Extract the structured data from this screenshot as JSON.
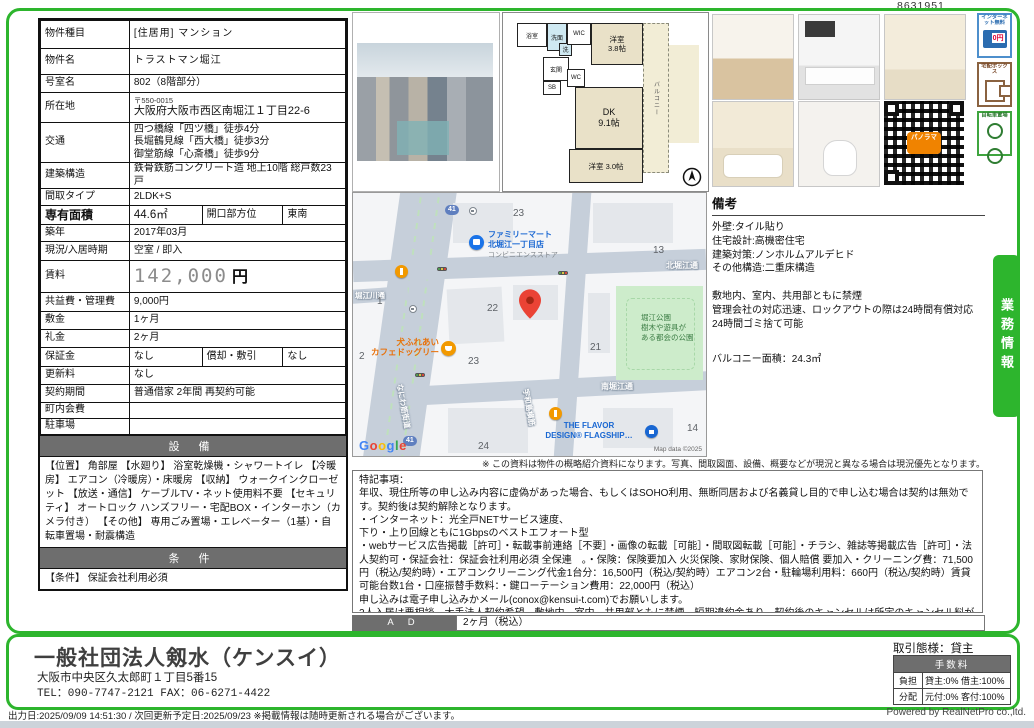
{
  "doc_number": "8631951",
  "property": {
    "rows": [
      {
        "label": "物件種目",
        "value": "[住居用] マンション"
      },
      {
        "label": "物件名",
        "value": "トラストマン堀江"
      },
      {
        "label": "号室名",
        "value": "802（8階部分）"
      },
      {
        "label": "所在地",
        "zip": "〒550-0015",
        "value": "大阪府大阪市西区南堀江１丁目22-6"
      },
      {
        "label": "交通",
        "value": "四つ橋線「四ツ橋」徒歩4分\n長堀鶴見線「西大橋」徒歩3分\n御堂筋線「心斎橋」徒歩9分"
      },
      {
        "label": "建築構造",
        "value": "鉄骨鉄筋コンクリート造 地上10階 総戸数23戸"
      },
      {
        "label": "間取タイプ",
        "value": "2LDK+S"
      },
      {
        "label": "専有面積",
        "value": "44.6㎡",
        "label2": "開口部方位",
        "value2": "東南"
      },
      {
        "label": "築年",
        "value": "2017年03月"
      },
      {
        "label": "現況/入居時期",
        "value": "空室 / 即入"
      },
      {
        "label": "賃料",
        "value": "142,000",
        "unit": "円"
      },
      {
        "label": "共益費・管理費",
        "value": "9,000円"
      },
      {
        "label": "敷金",
        "value": "1ヶ月"
      },
      {
        "label": "礼金",
        "value": "2ヶ月"
      },
      {
        "label": "保証金",
        "value": "なし",
        "label2": "償却・敷引",
        "value2": "なし"
      },
      {
        "label": "更新料",
        "value": "なし"
      },
      {
        "label": "契約期間",
        "value": "普通借家 2年間 再契約可能"
      },
      {
        "label": "町内会費",
        "value": ""
      },
      {
        "label": "駐車場",
        "value": ""
      }
    ]
  },
  "equipment": {
    "header": "設 備",
    "text": "【位置】 角部屋 【水廻り】 浴室乾燥機・シャワートイレ 【冷暖房】 エアコン（冷暖房）・床暖房 【収納】 ウォークインクローゼット 【放送・通信】 ケーブルTV・ネット使用料不要 【セキュリティ】 オートロック ハンズフリー・宅配BOX・インターホン（カメラ付き） 【その他】 専用ごみ置場・エレベーター（1基）・自転車置場・耐震構造"
  },
  "conditions": {
    "header": "条 件",
    "text": "【条件】 保証会社利用必須"
  },
  "floorplan": {
    "bath": "浴室",
    "wash": "洗面",
    "laundry": "洗",
    "wic": "WIC",
    "entrance": "玄関",
    "sb": "SB",
    "wc": "WC",
    "bedroom1": "洋室\n3.8帖",
    "dk": "DK\n9.1帖",
    "bedroom2": "洋室 3.0帖",
    "balcony": "バルコニー"
  },
  "badges": [
    {
      "label": "インターネット無料",
      "sub": "0円"
    },
    {
      "label": "宅配ボックス",
      "sub": ""
    },
    {
      "label": "自転車置場",
      "sub": ""
    }
  ],
  "qr": {
    "caption": "パノラマ"
  },
  "map": {
    "poi_familymart_name": "ファミリーマート\n北堀江一丁目店",
    "poi_familymart_type": "コンビニエンスストア",
    "poi_cafe": "犬ふれあい\nカフェドッグリー",
    "poi_flavor": "THE FLAVOR\nDESIGN® FLAGSHIP…",
    "park": "堀江公園\n樹木や遊具が\nある都会の公園",
    "road_north": "北堀江通",
    "road_south": "南堀江通",
    "road_west": "堀江川通",
    "road_naniwa": "なにわ筋街道",
    "road_vertical": "宇和島横筋",
    "route_shield": "41",
    "blocks": [
      "23",
      "13",
      "1",
      "22",
      "2",
      "23",
      "21",
      "24",
      "14"
    ],
    "google_letters": [
      "G",
      "o",
      "o",
      "g",
      "l",
      "e"
    ],
    "attribution": "Map data ©2025"
  },
  "remarks": {
    "title": "備考",
    "text": "外壁:タイル貼り\n住宅設計:高機密住宅\n建築対策:ノンホルムアルデヒド\nその他構造:二重床構造\n\n敷地内、室内、共用部ともに禁煙\n管理会社の対応迅速、ロックアウトの際は24時間有償対応\n24時間ゴミ捨て可能",
    "balcony": "バルコニー面積：24.3㎡"
  },
  "business_tab": "業務情報",
  "disclaimer": "※ この資料は物件の概略紹介資料になります。写真、間取図面、設備、概要などが現況と異なる場合は現況優先となります。",
  "special_notes": {
    "text": "特記事項：\n年収、現住所等の申し込み内容に虚偽があった場合、もしくはSOHO利用、無断同居および名義貸し目的で申し込む場合は契約は無効です。契約後は契約解除となります。\n・インターネット：光全戸NETサービス速度、\n下り・上り回線ともに1Gbpsのベストエフォート型\n・webサービス広告掲載［許可］・転載事前連絡［不要］・画像の転載［可能］・間取図転載［可能］・チラシ、雑誌等掲載広告［許可］・法人契約可・保証会社：保証会社利用必須 全保連　。・保険：保険要加入 火災保険、家財保険、個人賠償 要加入・クリーニング費：71,500円（税込/契約時）・エアコンクリーニング代金1台分：16,500円（税込/契約時）エアコン2台・駐輪場利用料：660円（税込/契約時）賃貸可能台数1台・口座振替手数料：・鍵ローテーション費用：22,000円（税込）\n申し込みは電子申し込みかメール(conox@kensui-t.com)でお願いします。\n2人入居は要相談、大手法人契約希望、敷地内、室内、共用部ともに禁煙　短期違約金あり。契約後のキャンセルは所定のキャンセル料が発生します。(応相談)\n■ カギ所在：株式会社アフロ　AFLO西大橋堀江店　06-6536-5556"
  },
  "ad": {
    "label": "A D",
    "value": "2ヶ月（税込）"
  },
  "company": {
    "name": "一般社団法人剱水（ケンスイ）",
    "address": "大阪市中央区久太郎町１丁目5番15",
    "tel": "TEL：090-7747-2121 FAX：06-6271-4422"
  },
  "transaction": {
    "mode": "取引態様：貸主",
    "fee_header": "手数料",
    "rows": [
      {
        "label": "負担",
        "value": "貸主:0% 借主:100%"
      },
      {
        "label": "分配",
        "value": "元付:0% 客付:100%"
      }
    ]
  },
  "footer": {
    "left": "出力日:2025/09/09 14:51:30 / 次回更新予定日:2025/09/23 ※掲載情報は随時更新される場合がございます。",
    "powered": "Powered by RealNetPro co.,ltd."
  }
}
